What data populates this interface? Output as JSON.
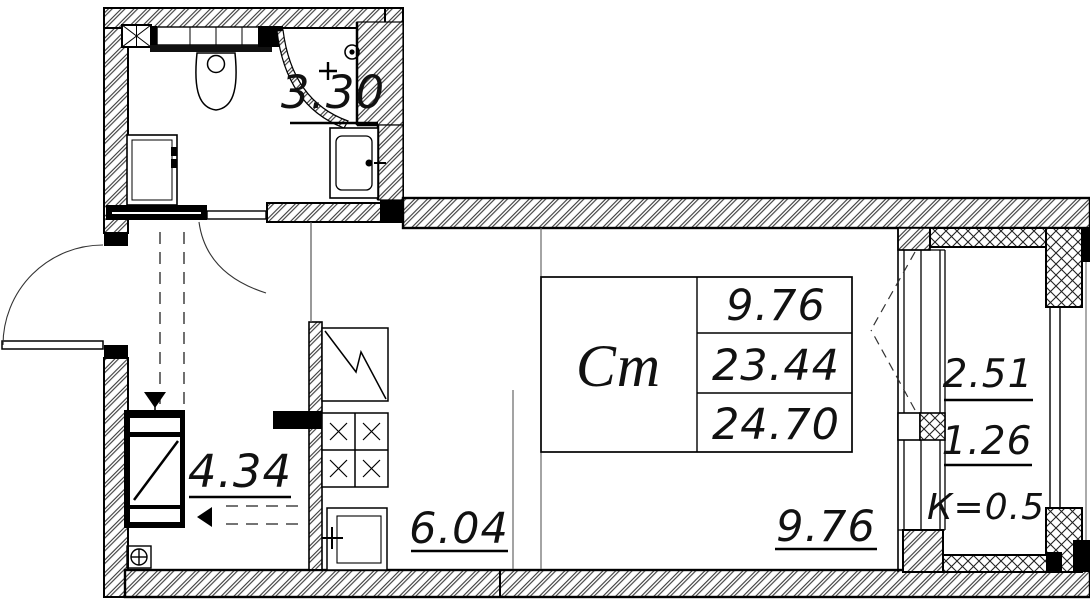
{
  "plan": {
    "title": "studio-apartment-floor-plan",
    "rooms": {
      "bathroom": {
        "area": "3.30"
      },
      "hallway": {
        "area": "4.34"
      },
      "kitchen": {
        "area": "6.04"
      },
      "living": {
        "area": "9.76"
      }
    },
    "table": {
      "room_label": "Ст",
      "living_area": "9.76",
      "area_without_balcony": "23.44",
      "total_area": "24.70"
    },
    "balcony": {
      "area": "2.51",
      "reduced_area": "1.26",
      "coefficient": "К=0.5"
    },
    "colors": {
      "ink": "#111111",
      "paper": "#ffffff"
    }
  }
}
